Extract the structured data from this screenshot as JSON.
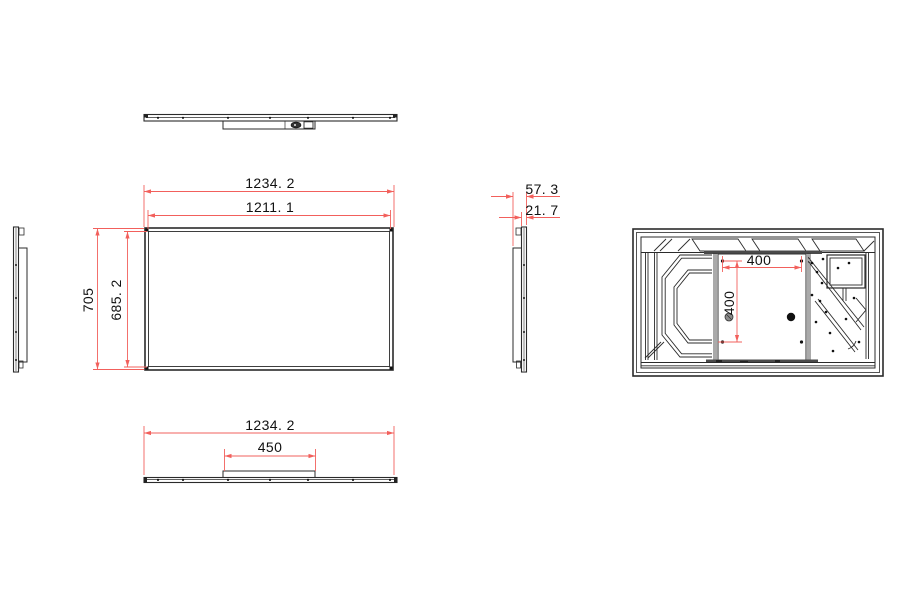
{
  "drawing": {
    "kind": "display-panel-technical-drawing",
    "background": "#ffffff",
    "line_color": "#2b2b2b",
    "dimension_color": "#f2605c"
  },
  "dims": {
    "front_width_outer": {
      "label": "1234. 2",
      "value": 1234.2
    },
    "front_width_inner": {
      "label": "1211. 1",
      "value": 1211.1
    },
    "front_height_outer": {
      "label": "705",
      "value": 705
    },
    "front_height_inner": {
      "label": "685. 2",
      "value": 685.2
    },
    "side_depth_total": {
      "label": "57. 3",
      "value": 57.3
    },
    "side_depth_panel": {
      "label": "21. 7",
      "value": 21.7
    },
    "vesa_width": {
      "label": "400",
      "value": 400
    },
    "vesa_height": {
      "label": "400",
      "value": 400
    },
    "bottom_width": {
      "label": "1234. 2",
      "value": 1234.2
    },
    "bottom_stand_width": {
      "label": "450",
      "value": 450
    }
  }
}
